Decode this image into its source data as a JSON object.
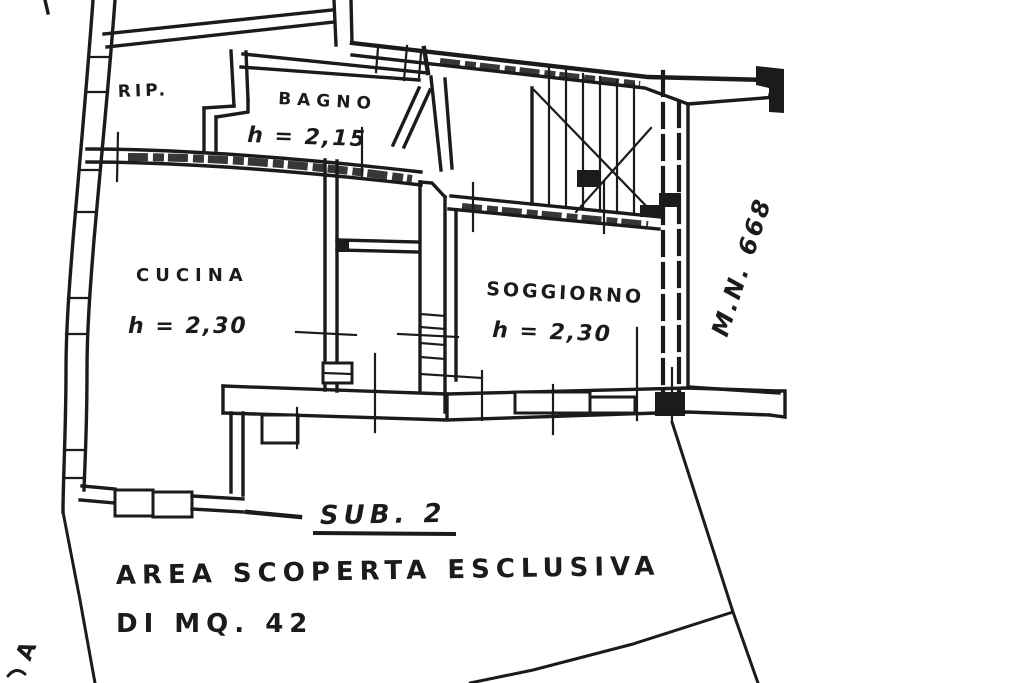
{
  "plan": {
    "rooms": {
      "rip": {
        "label": "RIP."
      },
      "bagno": {
        "label": "BAGNO",
        "height": "h = 2,15"
      },
      "cucina": {
        "label": "CUCINA",
        "height": "h = 2,30"
      },
      "soggiorno": {
        "label": "SOGGIORNO",
        "height": "h = 2,30"
      }
    },
    "annotations": {
      "map_number": "M.N. 668",
      "subunit": "SUB. 2",
      "area_line1": "AREA SCOPERTA ESCLUSIVA",
      "area_line2": "DI MQ. 42",
      "edge_letter": "A"
    },
    "colors": {
      "ink": "#1b1b1b",
      "paper": "#ffffff"
    }
  }
}
